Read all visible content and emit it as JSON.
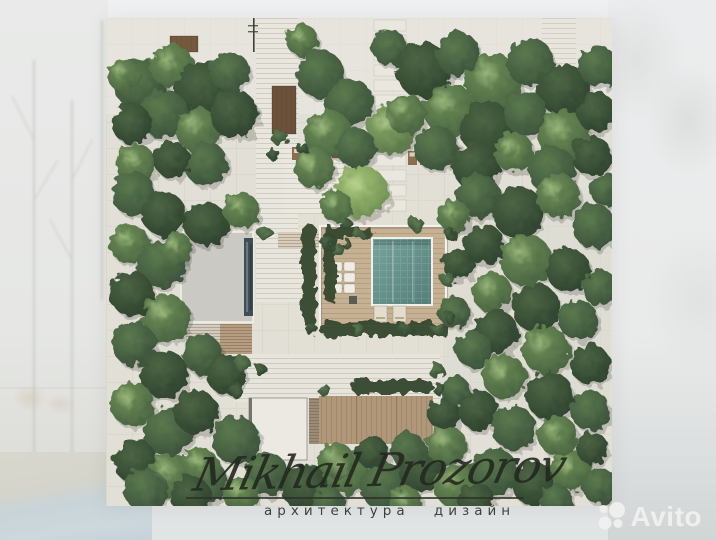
{
  "watermark": {
    "signature": "Mikhail Prozorov",
    "subtitle": "архитектура дизайн",
    "brand": "Avito"
  },
  "scene": {
    "plan_px": {
      "left": 106,
      "top": 18,
      "width": 506,
      "height": 488
    },
    "palette": {
      "plan_base": "#e1dfd6",
      "grid_line": "rgba(70,62,48,0.05)",
      "path": "#e8e6dd",
      "deck_warm": "#c6b193",
      "deck_wood": "#b1977a",
      "roof_gray": "#cac9c3",
      "roof_white": "#ebe9e2",
      "skylight": "#3f4d56",
      "planter": "#6b5139",
      "pool": [
        "#7aa49e",
        "#527d78"
      ],
      "pool_border": "#eef0ea",
      "hedge": "#36492f",
      "tree_gradients": [
        [
          "#4d6644",
          "#2c402d"
        ],
        [
          "#5b7a4e",
          "#394f3a"
        ],
        [
          "#6f9158",
          "#46603f"
        ],
        [
          "#8aab68",
          "#567247"
        ],
        [
          "#a6c577",
          "#6a8a50"
        ]
      ],
      "tree_highlight": "#cadfa3",
      "tree_shadow": "#1f2b1c",
      "lounger_brown": "#8a6f4f",
      "lounger_white": "#efede5",
      "signature_ink": "#23281f",
      "avito_white": "#f1f2f0"
    },
    "paths": [
      {
        "x": 150,
        "y": 0,
        "w": 42,
        "h": 212,
        "f": "#e8e6dd",
        "l": "h"
      },
      {
        "x": 150,
        "y": 212,
        "w": 46,
        "h": 72,
        "f": "#e7e5dc",
        "l": "h"
      },
      {
        "x": 178,
        "y": 126,
        "w": 74,
        "h": 70,
        "f": "#eae8df",
        "l": "h"
      },
      {
        "x": 128,
        "y": 336,
        "w": 206,
        "h": 48,
        "f": "#e6e4db",
        "l": "h"
      },
      {
        "x": 340,
        "y": 176,
        "w": 164,
        "h": 230,
        "f": "#dcdad2",
        "o": 0.55
      },
      {
        "x": 436,
        "y": 0,
        "w": 34,
        "h": 150,
        "f": "#e7e5dc",
        "l": "h",
        "o": 0.85
      }
    ],
    "pavers": {
      "x": 268,
      "y0": 2,
      "y1": 186,
      "step": 15,
      "w": 32,
      "h": 11,
      "f": "#e9e7de"
    },
    "planters": [
      {
        "x": 166,
        "y": 68,
        "w": 24,
        "h": 48,
        "f": "#6b5139",
        "l": "v"
      },
      {
        "x": 64,
        "y": 18,
        "w": 28,
        "h": 16,
        "f": "#75593d",
        "l": "v"
      },
      {
        "x": 379,
        "y": 66,
        "w": 16,
        "h": 46,
        "f": "#6b5139",
        "l": "v"
      }
    ],
    "buildings": [
      {
        "x": 75,
        "y": 214,
        "w": 72,
        "h": 90,
        "f": "#cac9c3",
        "st": "#f2f1ea",
        "sw": 1.5
      },
      {
        "x": 138,
        "y": 220,
        "w": 9,
        "h": 78,
        "f": "#3f4d56"
      },
      {
        "x": 140,
        "y": 224,
        "w": 2,
        "h": 70,
        "f": "#6e828d",
        "o": 0.85
      },
      {
        "x": 144,
        "y": 226,
        "w": 1.5,
        "h": 66,
        "f": "#2b363d",
        "o": 0.85
      },
      {
        "x": 80,
        "y": 306,
        "w": 34,
        "h": 30,
        "f": "#d3ccbf",
        "l": "s"
      },
      {
        "x": 114,
        "y": 306,
        "w": 32,
        "h": 30,
        "f": "#b79d80",
        "l": "s"
      },
      {
        "x": 143,
        "y": 380,
        "w": 58,
        "h": 62,
        "f": "#ebe9e2",
        "st": "#8a8a85",
        "sw": 0.8
      },
      {
        "x": 143,
        "y": 380,
        "w": 3,
        "h": 62,
        "f": "#74746e"
      },
      {
        "x": 203,
        "y": 380,
        "w": 10,
        "h": 46,
        "f": "#9b8c77",
        "l": "s"
      },
      {
        "x": 213,
        "y": 378,
        "w": 114,
        "h": 48,
        "f": "#b1977a",
        "l": "v"
      },
      {
        "x": 250,
        "y": 378,
        "w": 1.2,
        "h": 48,
        "f": "#8d744f",
        "o": 0.7
      },
      {
        "x": 290,
        "y": 378,
        "w": 1.2,
        "h": 48,
        "f": "#8d744f",
        "o": 0.7
      }
    ],
    "courtyard": {
      "deck": {
        "x": 214,
        "y": 208,
        "w": 126,
        "h": 100,
        "f": "#c6b193",
        "l": "h"
      },
      "wall": {
        "x": 214,
        "y": 208,
        "w": 126,
        "h": 100
      },
      "steps": {
        "x": 172,
        "y": 214,
        "w": 44,
        "h": 16,
        "f": "#d9cdb9",
        "l": "s"
      },
      "pool": {
        "x": 266,
        "y": 220,
        "w": 60,
        "h": 67
      },
      "lanes": [
        286,
        306
      ],
      "loungers_white": {
        "x": 225,
        "y": 244,
        "cols": 2,
        "rows": 3,
        "cw": 11,
        "ch": 9,
        "gap": 2
      },
      "table_dark": {
        "x": 243,
        "y": 278,
        "w": 8,
        "h": 8,
        "f": "#5b5b56"
      },
      "loungers_bottom": [
        {
          "x": 268,
          "y": 288,
          "w": 13,
          "h": 16
        },
        {
          "x": 287,
          "y": 288,
          "w": 13,
          "h": 16
        }
      ]
    },
    "furniture": {
      "terrace_loungers": [
        {
          "x": 186,
          "y": 129,
          "w": 18,
          "h": 13
        },
        {
          "x": 206,
          "y": 129,
          "w": 18,
          "h": 13
        }
      ],
      "terrace_table": {
        "x": 226,
        "y": 132,
        "w": 8,
        "h": 8,
        "f": "#7a6045"
      },
      "right_loungers": [
        {
          "x": 302,
          "y": 133,
          "w": 9,
          "h": 14
        },
        {
          "x": 314,
          "y": 133,
          "w": 9,
          "h": 14
        },
        {
          "x": 326,
          "y": 133,
          "w": 9,
          "h": 14
        },
        {
          "x": 338,
          "y": 133,
          "w": 9,
          "h": 14
        }
      ],
      "dark_box": {
        "x": 240,
        "y": 176,
        "w": 8,
        "h": 8,
        "f": "#55544e"
      },
      "pole": {
        "x": 147,
        "y": 0,
        "h": 34
      }
    },
    "hedges": [
      [
        196,
        206,
        14,
        102
      ],
      [
        214,
        304,
        128,
        14
      ],
      [
        218,
        216,
        12,
        68
      ],
      [
        245,
        362,
        82,
        13
      ],
      [
        216,
        210,
        52,
        10
      ]
    ],
    "bushes": [
      [
        222,
        226,
        7,
        0
      ],
      [
        232,
        232,
        6,
        1
      ],
      [
        241,
        226,
        5,
        0
      ],
      [
        160,
        216,
        7,
        1
      ],
      [
        174,
        120,
        8,
        1
      ],
      [
        167,
        136,
        6,
        0
      ],
      [
        206,
        312,
        6,
        0
      ],
      [
        252,
        312,
        6,
        1
      ],
      [
        300,
        312,
        7,
        0
      ],
      [
        332,
        310,
        6,
        1
      ],
      [
        137,
        346,
        8,
        1
      ],
      [
        155,
        352,
        6,
        0
      ],
      [
        330,
        352,
        8,
        1
      ],
      [
        240,
        206,
        6,
        0
      ],
      [
        310,
        206,
        7,
        1
      ],
      [
        344,
        216,
        6,
        0
      ],
      [
        342,
        262,
        7,
        1
      ],
      [
        344,
        300,
        6,
        0
      ],
      [
        130,
        372,
        7,
        0
      ],
      [
        218,
        372,
        6,
        1
      ],
      [
        334,
        372,
        6,
        0
      ],
      [
        196,
        130,
        6,
        0
      ],
      [
        252,
        216,
        5,
        1
      ]
    ],
    "trees": [
      [
        34,
        66,
        26,
        1
      ],
      [
        66,
        48,
        22,
        2
      ],
      [
        98,
        72,
        28,
        0
      ],
      [
        58,
        96,
        24,
        1
      ],
      [
        26,
        106,
        20,
        0
      ],
      [
        92,
        112,
        22,
        2
      ],
      [
        124,
        54,
        20,
        1
      ],
      [
        128,
        96,
        24,
        0
      ],
      [
        18,
        58,
        16,
        2
      ],
      [
        100,
        146,
        22,
        1
      ],
      [
        66,
        142,
        18,
        0
      ],
      [
        30,
        146,
        20,
        2
      ],
      [
        196,
        22,
        16,
        2
      ],
      [
        214,
        56,
        24,
        1
      ],
      [
        243,
        84,
        24,
        1
      ],
      [
        284,
        112,
        24,
        3
      ],
      [
        222,
        116,
        24,
        2
      ],
      [
        250,
        130,
        20,
        1
      ],
      [
        208,
        150,
        20,
        2
      ],
      [
        256,
        174,
        26,
        4
      ],
      [
        230,
        188,
        16,
        2
      ],
      [
        284,
        30,
        18,
        1
      ],
      [
        318,
        52,
        28,
        0
      ],
      [
        352,
        36,
        22,
        1
      ],
      [
        388,
        64,
        28,
        2
      ],
      [
        424,
        44,
        24,
        1
      ],
      [
        458,
        72,
        26,
        0
      ],
      [
        492,
        48,
        20,
        1
      ],
      [
        344,
        92,
        26,
        2
      ],
      [
        382,
        112,
        28,
        0
      ],
      [
        420,
        96,
        22,
        1
      ],
      [
        458,
        118,
        26,
        2
      ],
      [
        490,
        94,
        20,
        0
      ],
      [
        330,
        130,
        22,
        1
      ],
      [
        370,
        148,
        24,
        0
      ],
      [
        408,
        134,
        20,
        2
      ],
      [
        446,
        152,
        24,
        1
      ],
      [
        486,
        138,
        20,
        0
      ],
      [
        500,
        172,
        16,
        1
      ],
      [
        300,
        96,
        20,
        2
      ],
      [
        28,
        176,
        22,
        1
      ],
      [
        58,
        196,
        22,
        0
      ],
      [
        24,
        226,
        20,
        2
      ],
      [
        56,
        246,
        24,
        1
      ],
      [
        26,
        276,
        22,
        0
      ],
      [
        60,
        300,
        24,
        2
      ],
      [
        28,
        326,
        22,
        1
      ],
      [
        58,
        356,
        24,
        0
      ],
      [
        26,
        386,
        22,
        2
      ],
      [
        62,
        414,
        24,
        1
      ],
      [
        30,
        444,
        22,
        0
      ],
      [
        64,
        458,
        22,
        2
      ],
      [
        100,
        464,
        22,
        1
      ],
      [
        96,
        336,
        20,
        1
      ],
      [
        120,
        356,
        20,
        0
      ],
      [
        70,
        230,
        16,
        2
      ],
      [
        100,
        206,
        22,
        0
      ],
      [
        135,
        192,
        18,
        2
      ],
      [
        90,
        394,
        22,
        0
      ],
      [
        130,
        422,
        24,
        1
      ],
      [
        95,
        448,
        18,
        2
      ],
      [
        40,
        472,
        22,
        1
      ],
      [
        85,
        478,
        20,
        0
      ],
      [
        160,
        456,
        22,
        1
      ],
      [
        200,
        470,
        24,
        0
      ],
      [
        240,
        454,
        22,
        2
      ],
      [
        278,
        468,
        24,
        1
      ],
      [
        315,
        452,
        22,
        0
      ],
      [
        350,
        468,
        22,
        2
      ],
      [
        388,
        454,
        24,
        1
      ],
      [
        428,
        466,
        22,
        0
      ],
      [
        465,
        452,
        20,
        2
      ],
      [
        494,
        468,
        18,
        1
      ],
      [
        135,
        476,
        18,
        2
      ],
      [
        370,
        482,
        18,
        0
      ],
      [
        300,
        484,
        16,
        2
      ],
      [
        222,
        484,
        16,
        1
      ],
      [
        450,
        482,
        16,
        1
      ],
      [
        230,
        442,
        18,
        2
      ],
      [
        266,
        434,
        16,
        0
      ],
      [
        302,
        432,
        18,
        1
      ],
      [
        340,
        427,
        20,
        2
      ],
      [
        372,
        178,
        22,
        1
      ],
      [
        412,
        194,
        26,
        0
      ],
      [
        452,
        178,
        22,
        2
      ],
      [
        488,
        208,
        22,
        1
      ],
      [
        378,
        226,
        20,
        0
      ],
      [
        420,
        242,
        26,
        2
      ],
      [
        462,
        252,
        22,
        0
      ],
      [
        494,
        270,
        18,
        1
      ],
      [
        386,
        274,
        20,
        2
      ],
      [
        430,
        290,
        24,
        0
      ],
      [
        472,
        302,
        20,
        1
      ],
      [
        390,
        314,
        22,
        0
      ],
      [
        440,
        332,
        24,
        2
      ],
      [
        484,
        346,
        20,
        0
      ],
      [
        368,
        332,
        18,
        1
      ],
      [
        398,
        358,
        22,
        2
      ],
      [
        444,
        378,
        24,
        0
      ],
      [
        484,
        392,
        20,
        1
      ],
      [
        372,
        392,
        20,
        0
      ],
      [
        408,
        410,
        22,
        1
      ],
      [
        452,
        418,
        20,
        2
      ],
      [
        486,
        430,
        16,
        0
      ],
      [
        348,
        198,
        16,
        2
      ],
      [
        352,
        246,
        16,
        0
      ],
      [
        348,
        294,
        16,
        1
      ],
      [
        338,
        396,
        16,
        0
      ],
      [
        350,
        372,
        14,
        1
      ]
    ]
  }
}
